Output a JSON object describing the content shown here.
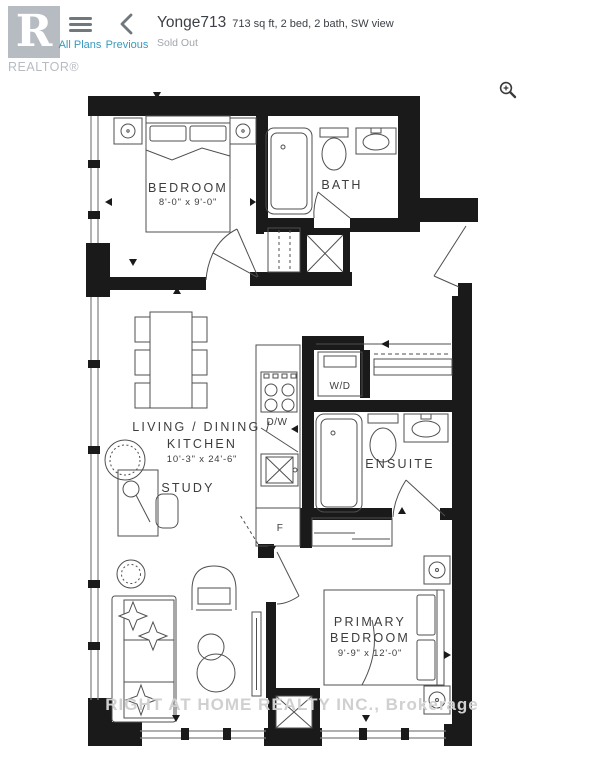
{
  "header": {
    "logo_text": "REALTOR®",
    "all_plans": "All Plans",
    "previous": "Previous",
    "title": "Yonge713",
    "subtitle": "713 sq ft, 2 bed, 2 bath, SW view",
    "status": "Sold Out"
  },
  "icons": {
    "menu": "hamburger-icon",
    "back": "chevron-left-icon",
    "zoom": "magnifier-plus-icon",
    "logo": "realtor-r-logo"
  },
  "colors": {
    "link": "#3899bd",
    "title_text": "#3c4146",
    "muted_text": "#9fa6ac",
    "logo_gray": "#b6bcc2",
    "wall_black": "#1a1a1a",
    "plan_line": "#4f4f4f",
    "watermark_gray": "#d0d0d0"
  },
  "floorplan": {
    "bedroom": {
      "name": "BEDROOM",
      "dims": "8'-0\" x 9'-0\""
    },
    "bath": {
      "name": "BATH"
    },
    "living": {
      "line1": "LIVING / DINING /",
      "line2": "KITCHEN",
      "dims": "10'-3\" x 24'-6\""
    },
    "study": {
      "name": "STUDY"
    },
    "ensuite": {
      "name": "ENSUITE"
    },
    "primary": {
      "line1": "PRIMARY",
      "line2": "BEDROOM",
      "dims": "9'-9\" x 12'-0\""
    },
    "appliances": {
      "washer_dryer": "W/D",
      "dishwasher": "D/W",
      "fridge": "F"
    },
    "watermark": "RIGHT AT HOME REALTY INC., Brokerage"
  }
}
